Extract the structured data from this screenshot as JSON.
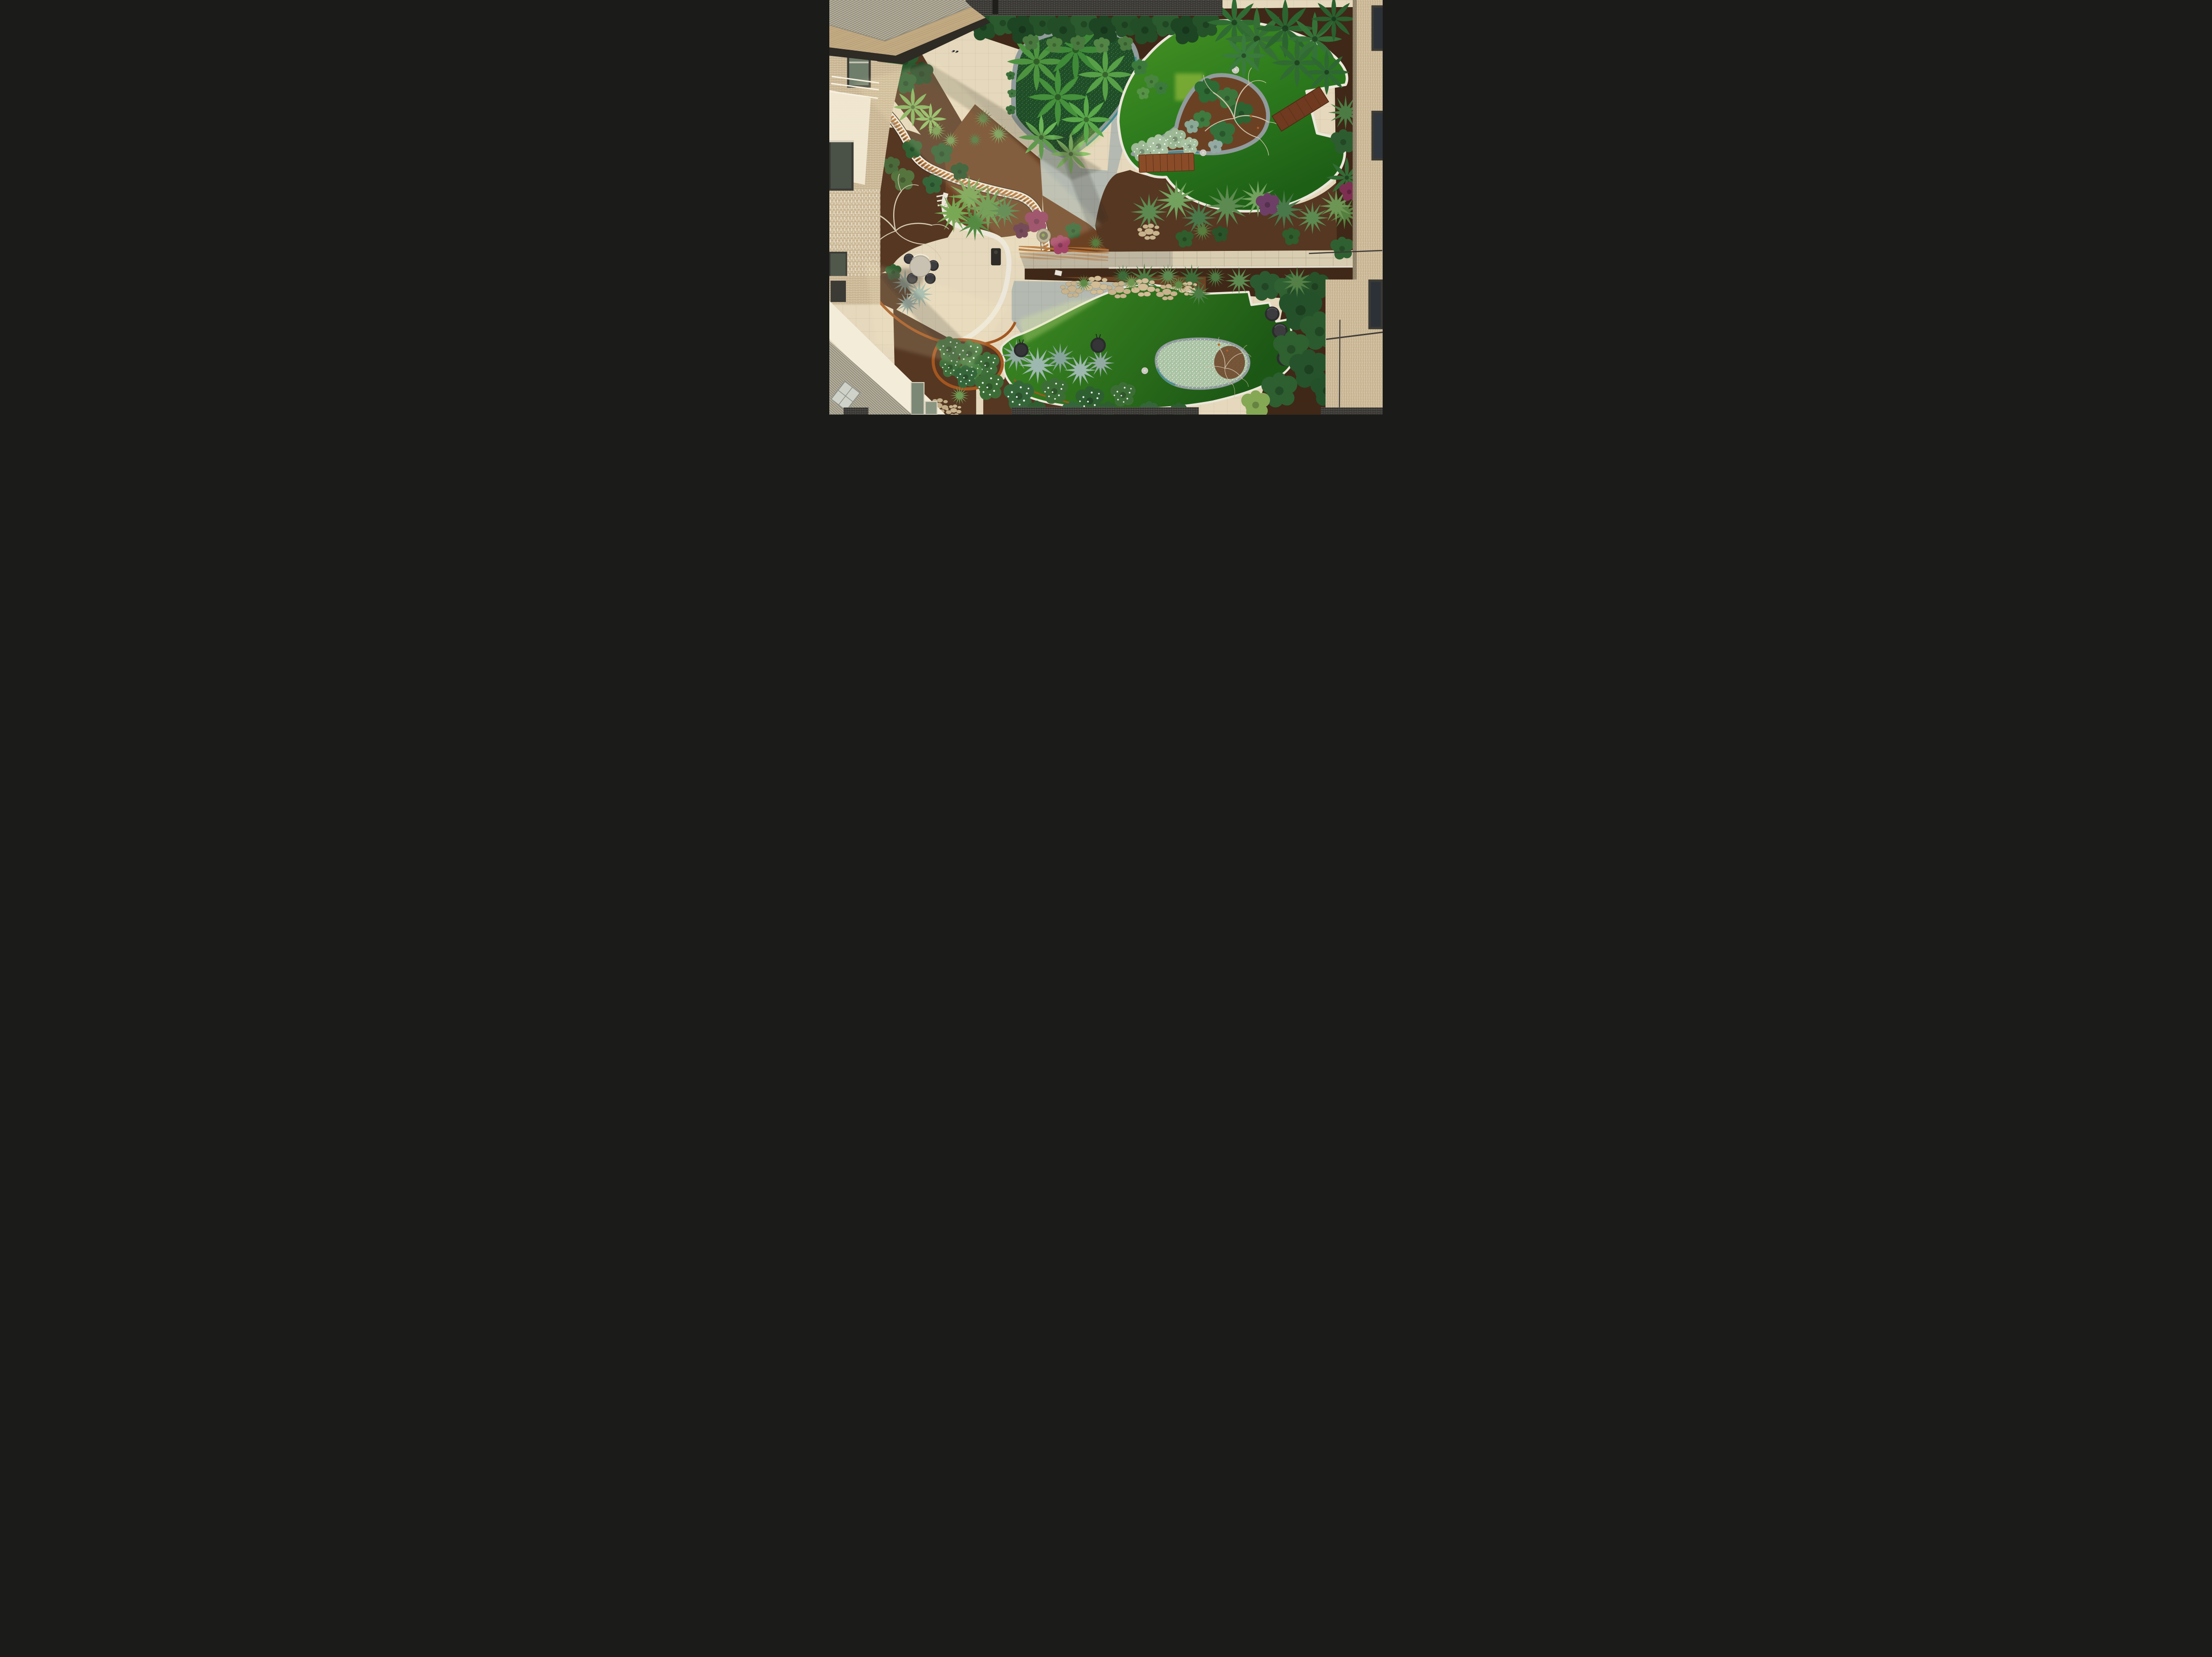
{
  "scene": {
    "type": "aerial-drone-photograph",
    "subject": "Landscaped apartment courtyard garden viewed from directly above",
    "lighting": "warm low sun from the upper right casting long diagonal shadows",
    "palette": {
      "turfA1": "#479324",
      "turfA2": "#2c7a1d",
      "turfA3": "#1e5f16",
      "turfB1": "#3f8d23",
      "turfB2": "#1c5715",
      "pavingWarm": "#e5d8bc",
      "pavingWarmLine": "#c9bb9e",
      "pavingCool": "#b4bab1",
      "pavingCoolLine": "#98a095",
      "stone": "#d9cdb1",
      "stoneLine": "#b9ad93",
      "mulch": "#553722",
      "mulchDark": "#3f2817",
      "mulchRed": "#6b4124",
      "edgeWhite": "#ece7da",
      "edgeGrey": "#909b9c",
      "teal": "#2f8b90",
      "corten": "#a3561f",
      "slat": "#b06c31",
      "timber": "#8a4c28",
      "timberDark": "#5a3017",
      "brickTan": "#c8b492",
      "brickMortar": "#e3d8be",
      "brickDark": "#34322e",
      "brickDarkMortar": "#80807a",
      "roof": "#b7b19e",
      "roofDark": "#8e897a",
      "soffit": "#c2aa83",
      "wallWhite": "#f3ecd9",
      "glass": "#6f7d6b",
      "frame": "#3b3a35",
      "foliageDark": "#224d27",
      "foliage": "#2f6132",
      "foliageLight": "#7fb05a",
      "silver": "#93aaa2",
      "magenta": "#8f3a5f",
      "flowerField": "#a9c2a2",
      "furnitureDark": "#323234",
      "tableTop": "#c9c2b2",
      "pot": "#b3a88e",
      "pebble": "#c8b38c"
    },
    "objects": {
      "lawns": 2,
      "drain_covers": 3,
      "benches": 2,
      "dining_table": "round outdoor dining table",
      "dining_chairs": 4,
      "wicker_lounge_chairs": 3,
      "pod_chairs": 2,
      "stone_planter_bowl": 1,
      "triangle_planter": "triangular raised planter with tree ferns and groundcover",
      "top_lawn_bed": "teardrop planting bed with bare deciduous tree and white flowering tail",
      "bottom_lawn_bed": "oval white-flowering planting bed",
      "screen": "curved timber slat screen over white retaining walls",
      "edging": "weathered corten steel garden edging",
      "buildings": "brick apartment facades on left, top and right"
    }
  }
}
